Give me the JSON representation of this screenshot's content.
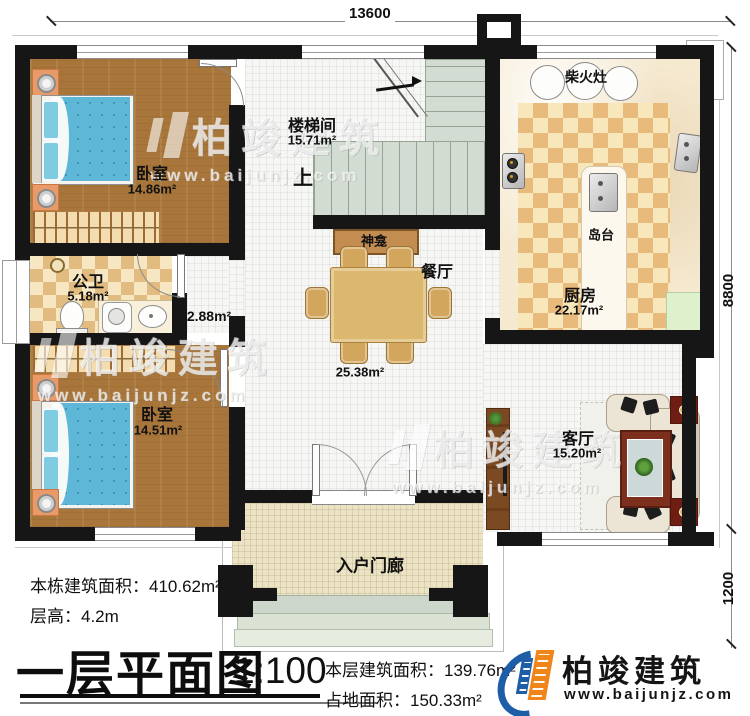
{
  "dimensions": {
    "top": "13600",
    "right_upper": "8800",
    "right_lower": "1200"
  },
  "rooms": {
    "bedroom_top": {
      "name": "卧室",
      "area": "14.86m²"
    },
    "stairwell": {
      "name": "楼梯间",
      "area": "15.71m²",
      "up_label": "上"
    },
    "shrine": {
      "name": "神龛"
    },
    "bathroom": {
      "name": "公卫",
      "area": "5.18m²"
    },
    "hallway": {
      "area": "2.88m²"
    },
    "bedroom_bottom": {
      "name": "卧室",
      "area": "14.51m²"
    },
    "dining": {
      "name": "餐厅",
      "area": "25.38m²"
    },
    "kitchen": {
      "name": "厨房",
      "area": "22.17m²",
      "wood_stove": "柴火灶",
      "island": "岛台"
    },
    "living": {
      "name": "客厅",
      "area": "15.20m²"
    },
    "porch": {
      "name": "入户门廊"
    }
  },
  "info": {
    "building_area_label": "本栋建筑面积：",
    "building_area_value": "410.62m²",
    "floor_height_label": "层高：",
    "floor_height_value": "4.2m",
    "title": "一层平面图",
    "scale": "1:100",
    "floor_area_label": "本层建筑面积：",
    "floor_area_value": "139.76m²",
    "footprint_label": "占地面积：",
    "footprint_value": "150.33m²"
  },
  "brand": {
    "name": "柏竣建筑",
    "url": "www.baijunjz.com"
  },
  "watermark": {
    "name": "柏竣建筑",
    "url": "www.baijunjz.com"
  },
  "colors": {
    "wall": "#161616",
    "wood_floor": "#a8763a",
    "bathroom_checker_dark": "#e2bb80",
    "kitchen_rug_dark": "#e8ba7c",
    "marble": "#f5e9d0",
    "stair_tread": "#d3dcd2",
    "porch": "#ebe3c3",
    "bed_blue": "#5fb7d7",
    "logo_blue": "#1e5da8",
    "logo_orange": "#f08619"
  }
}
